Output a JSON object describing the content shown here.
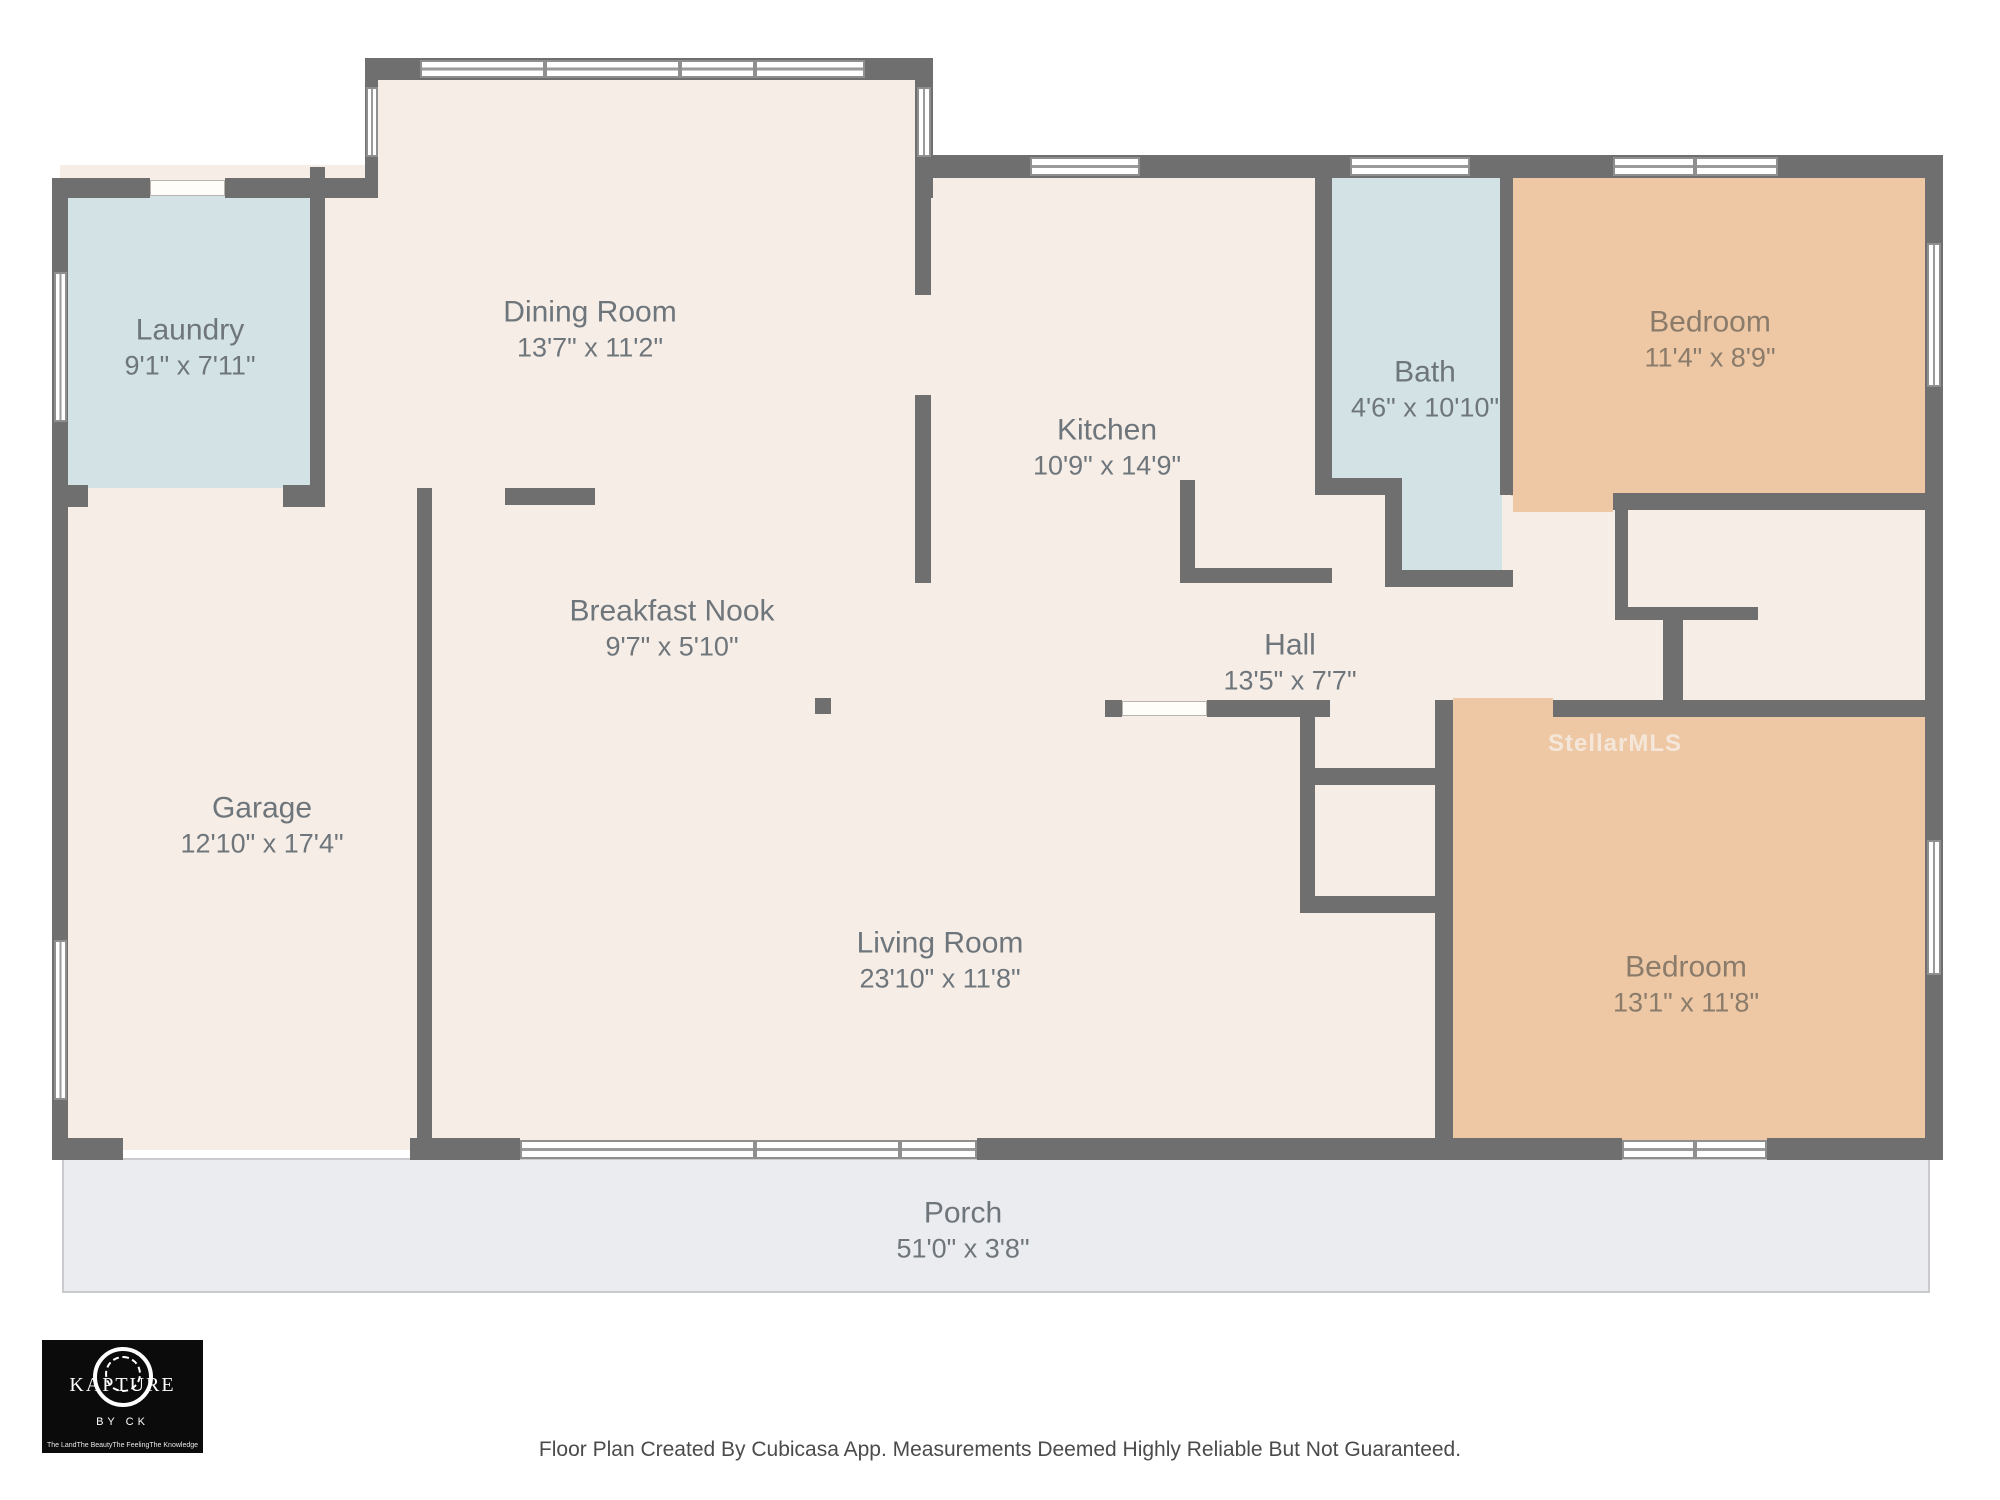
{
  "watermark": "StellarMLS",
  "footer": {
    "disclaimer": "Floor Plan Created By Cubicasa App. Measurements Deemed Highly Reliable But Not Guaranteed."
  },
  "logo": {
    "brand": "KAPTURE",
    "sub": "BY CK",
    "taglines": [
      "The Land",
      "The Beauty",
      "The Feeling",
      "The Knowledge"
    ]
  },
  "colors": {
    "wall": "#6f6f6f",
    "floor_cream": "#f6ede6",
    "floor_wet_blue": "#d3e2e5",
    "floor_bedroom_tan": "#eec8a4",
    "porch_gray": "#ebecef"
  },
  "rooms": [
    {
      "name": "Laundry",
      "dims": "9'1\" x 7'11\""
    },
    {
      "name": "Dining Room",
      "dims": "13'7\" x 11'2\""
    },
    {
      "name": "Kitchen",
      "dims": "10'9\" x 14'9\""
    },
    {
      "name": "Bath",
      "dims": "4'6\" x 10'10\""
    },
    {
      "name": "Bedroom",
      "dims": "11'4\" x 8'9\""
    },
    {
      "name": "Breakfast Nook",
      "dims": "9'7\" x 5'10\""
    },
    {
      "name": "Hall",
      "dims": "13'5\" x 7'7\""
    },
    {
      "name": "Garage",
      "dims": "12'10\" x 17'4\""
    },
    {
      "name": "Living Room",
      "dims": "23'10\" x 11'8\""
    },
    {
      "name": "Bedroom",
      "dims": "13'1\" x 11'8\""
    },
    {
      "name": "Porch",
      "dims": "51'0\" x 3'8\""
    }
  ]
}
